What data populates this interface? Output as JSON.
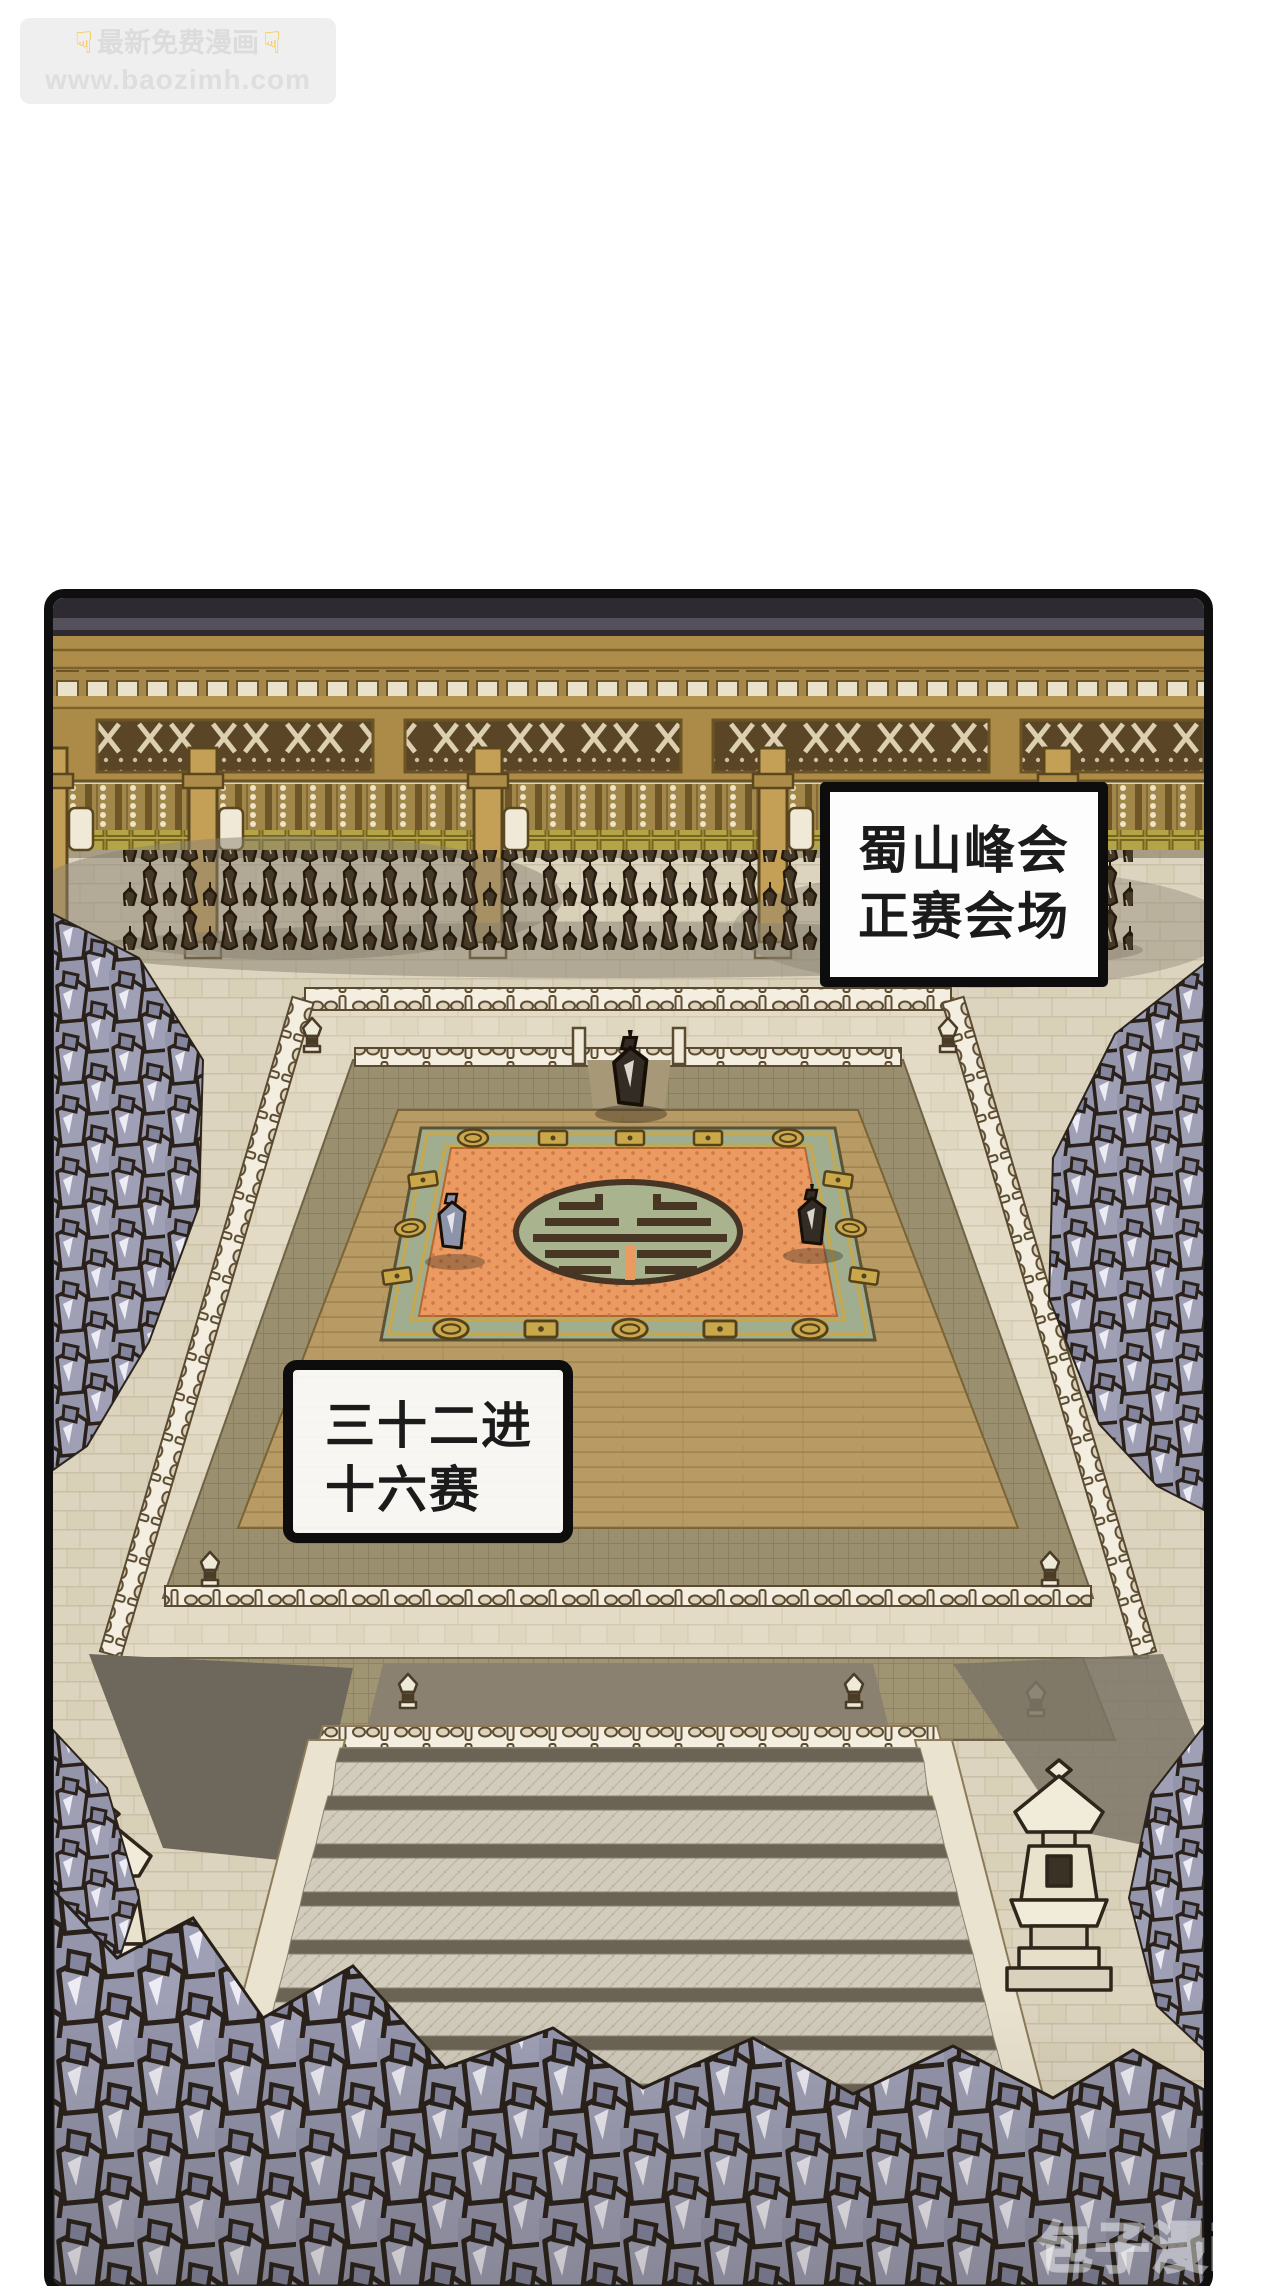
{
  "site_watermark": {
    "hand_icon": "☟",
    "line1": "最新免费漫画",
    "line2": "www.baozimh.com"
  },
  "panel": {
    "caption_boxes": [
      {
        "id": "venue",
        "line1": "蜀山峰会",
        "line2": "正赛会场"
      },
      {
        "id": "round",
        "line1": "三十二进",
        "line2": "十六赛"
      }
    ],
    "corner_watermark": "包子漫画"
  },
  "palette": {
    "panel_border": "#0f0f0f",
    "roof_dark": "#2d2a31",
    "wood_gold": "#ae8d4a",
    "plaza_cream": "#dcd4bf",
    "deck_tan": "#b89a64",
    "carpet_orange": "#eb9a62",
    "carpet_border_green": "#a0ad8e",
    "gold_trim": "#c9a84b",
    "crowd_purple": "#9a9bb1",
    "soldier_brown": "#463827",
    "stair_tread": "#d2ccbd",
    "stair_riser": "#6b6354",
    "watermark_bg": "#efefef",
    "watermark_text": "#dcdcdc",
    "hand_yellow": "#f2c235"
  }
}
